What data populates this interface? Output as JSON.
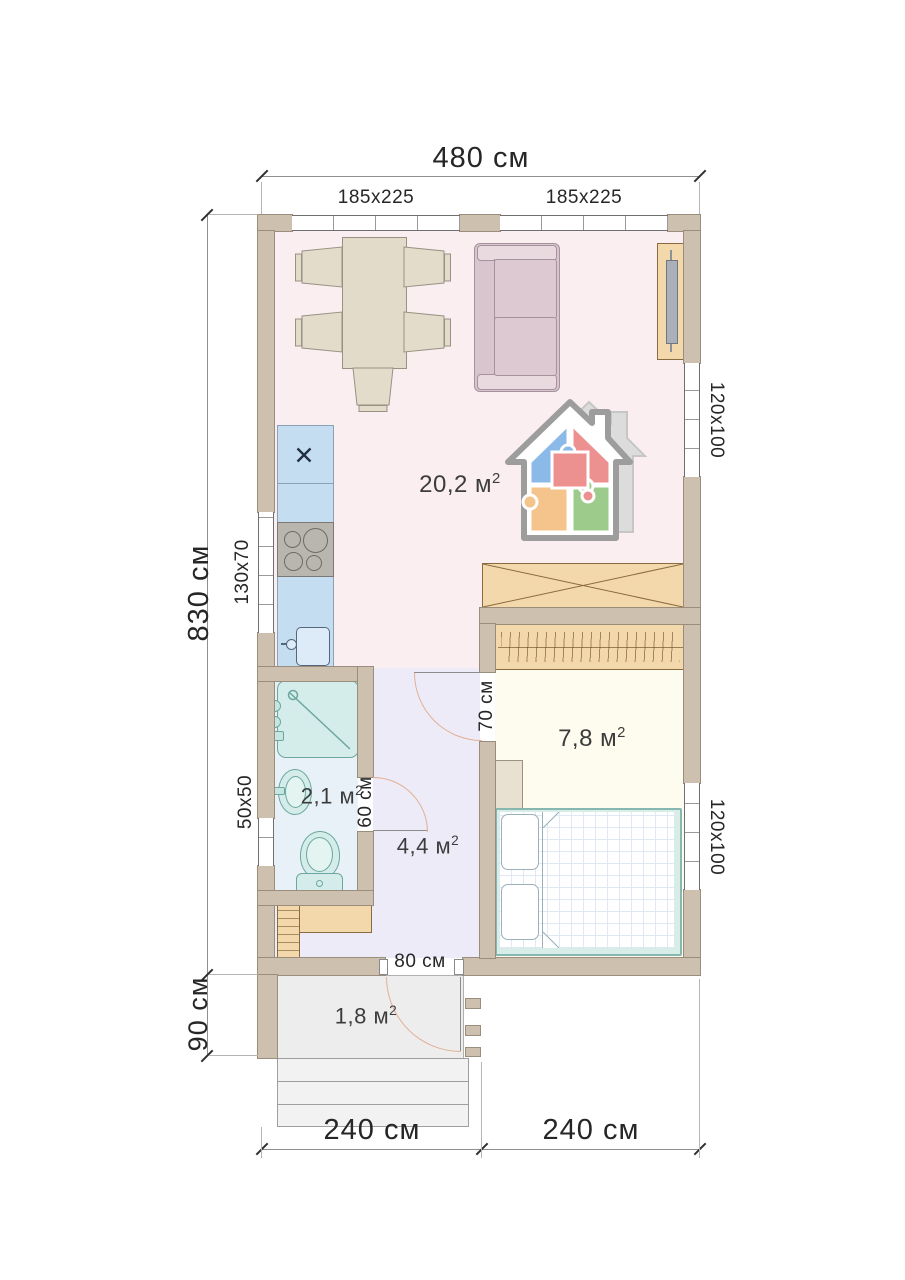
{
  "dimensions": {
    "total_width": "480 см",
    "total_height": "830 см",
    "porch_height": "90 см",
    "bottom_left_width": "240 см",
    "bottom_right_width": "240 см"
  },
  "windows": {
    "top_left": "185x225",
    "top_right": "185x225",
    "kitchen_side": "130x70",
    "bathroom_side": "50x50",
    "living_side": "120x100",
    "bedroom_side": "120x100"
  },
  "doors": {
    "interior_bedroom": "70 см",
    "interior_bathroom": "60 см",
    "entrance": "80 см"
  },
  "rooms": {
    "living_kitchen": {
      "area": "20,2"
    },
    "bedroom": {
      "area": "7,8"
    },
    "bathroom": {
      "area": "2,1"
    },
    "hallway": {
      "area": "4,4"
    },
    "porch": {
      "area": "1,8"
    }
  },
  "units": {
    "area_unit": "м",
    "area_exponent": "2"
  },
  "colors": {
    "wall": "#cdc0ae",
    "living_floor": "#faeef1",
    "hallway_floor": "#eeebf8",
    "bathroom_floor": "#e8f1f8",
    "bedroom_floor": "#fdfcee",
    "porch_floor": "#ededed",
    "kitchen_counter": "#c4ddf0",
    "wood_furniture": "#f3d8ab",
    "sanitary": "#d5edea",
    "sofa": "#d9c5cd",
    "door_arc": "#e0b093"
  }
}
